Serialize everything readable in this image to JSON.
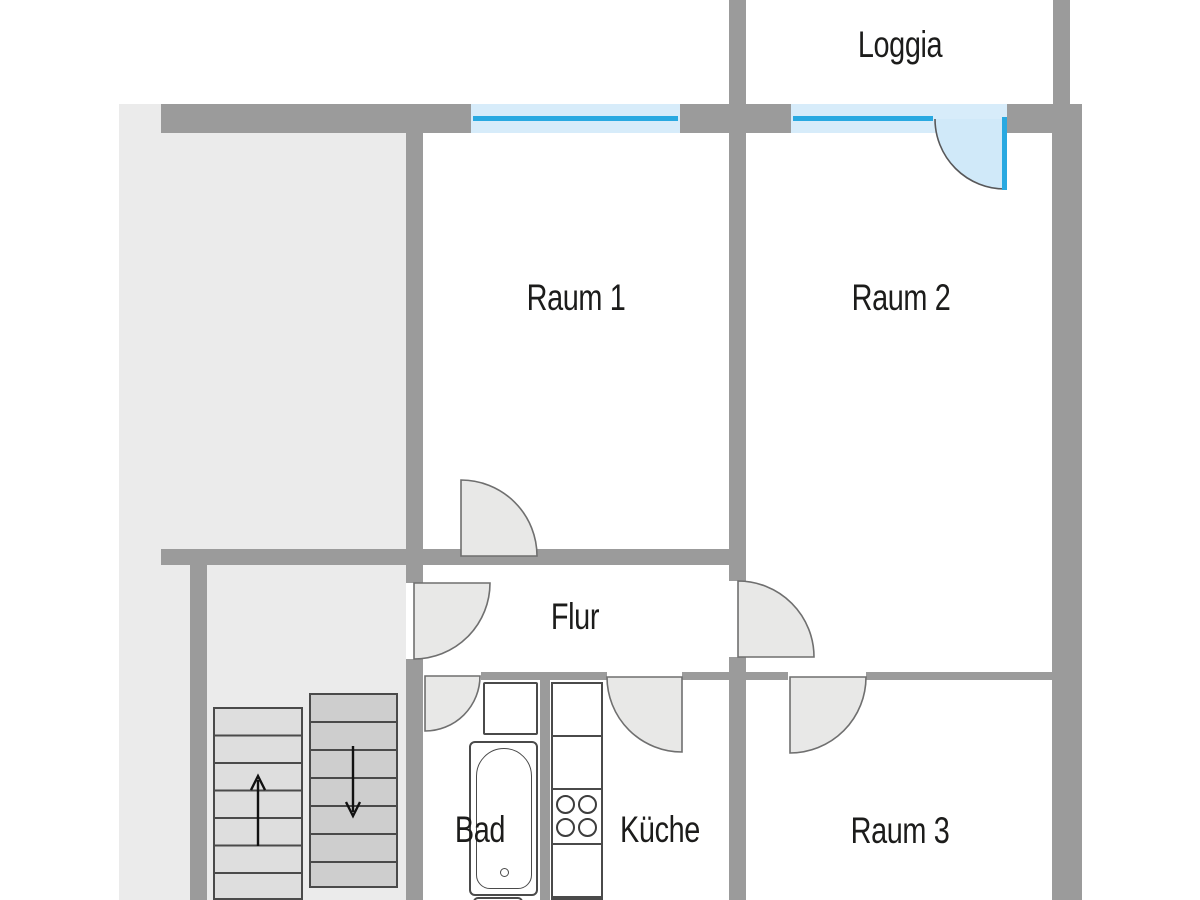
{
  "plan_type": "floor-plan",
  "labels": {
    "loggia": "Loggia",
    "raum1": "Raum 1",
    "raum2": "Raum 2",
    "flur": "Flur",
    "bad": "Bad",
    "kueche": "Küche",
    "raum3": "Raum 3"
  },
  "colors": {
    "wall": "#9b9b9b",
    "outside_area": "#ebebeb",
    "room_floor": "#ffffff",
    "door_fill": "#e8e8e7",
    "door_stroke": "#6f6f6f",
    "window_fill": "#d7ecfa",
    "window_line": "#29a9e1",
    "balcony_door_fill": "#d0e9f9",
    "fixture_stroke": "#4a4a4a",
    "stair_up_fill": "#dedede",
    "stair_down_fill": "#cecece",
    "label_text": "#1c1c1b",
    "arrow": "#111111"
  },
  "doors": [
    {
      "name": "raum1-door",
      "swings_into": "Raum 1"
    },
    {
      "name": "entrance-door",
      "swings_into": "Flur"
    },
    {
      "name": "flur-raum2-door",
      "swings_into": "Raum 2"
    },
    {
      "name": "bad-door",
      "swings_into": "Bad"
    },
    {
      "name": "kueche-door",
      "swings_into": "Küche"
    },
    {
      "name": "raum3-door",
      "swings_into": "Raum 3"
    },
    {
      "name": "balcony-door",
      "swings_into": "Raum 2",
      "style": "glass-blue"
    }
  ],
  "windows": [
    {
      "name": "raum1-window",
      "room": "Raum 1"
    },
    {
      "name": "raum2-window",
      "room": "Raum 2"
    }
  ],
  "stairs": {
    "left_flight": {
      "direction": "up",
      "treads": 7,
      "arrow": "↑"
    },
    "right_flight": {
      "direction": "down",
      "treads": 7,
      "arrow": "↓"
    }
  },
  "fixtures": {
    "bad": [
      "sink",
      "bathtub",
      "toilet"
    ],
    "kueche": {
      "units": 4,
      "stove_burners": 4
    }
  }
}
